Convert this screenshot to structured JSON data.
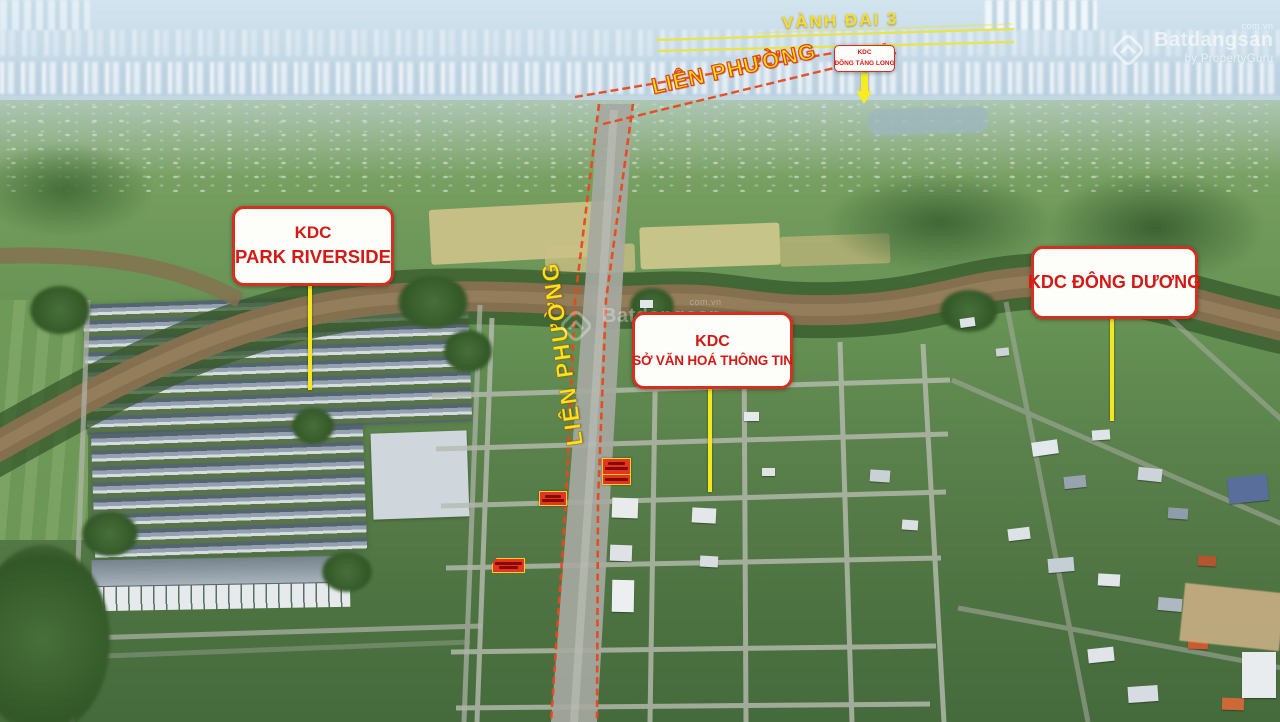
{
  "annotations": {
    "ring_road": {
      "label": "VÀNH ĐAI 3"
    },
    "street_diagonal": {
      "label": "LIÊN PHƯỜNG"
    },
    "street_vertical": {
      "label": "LIÊN PHƯỜNG"
    },
    "areas": {
      "dong_tang_long": {
        "line1": "KDC",
        "line2": "ĐÔNG TĂNG LONG"
      },
      "park_riverside": {
        "line1": "KDC",
        "line2": "PARK RIVERSIDE"
      },
      "so_van_hoa": {
        "line1": "KDC",
        "line2": "SỞ VĂN HOÁ THÔNG TIN"
      },
      "dong_duong": {
        "line1": "KDC ĐÔNG DƯƠNG"
      }
    }
  },
  "watermark": {
    "brand": "Batdangsan",
    "byline": "by PropertyGuru",
    "tld": "com.vn"
  },
  "colors": {
    "label_text_red": "#d31a15",
    "label_border_red": "#d5301f",
    "pointer_yellow": "#f5e71e",
    "road_outline_red": "#e8481c",
    "ring_road_yellow": "#e9e441",
    "street_text_yellow": "#ffe11c"
  }
}
